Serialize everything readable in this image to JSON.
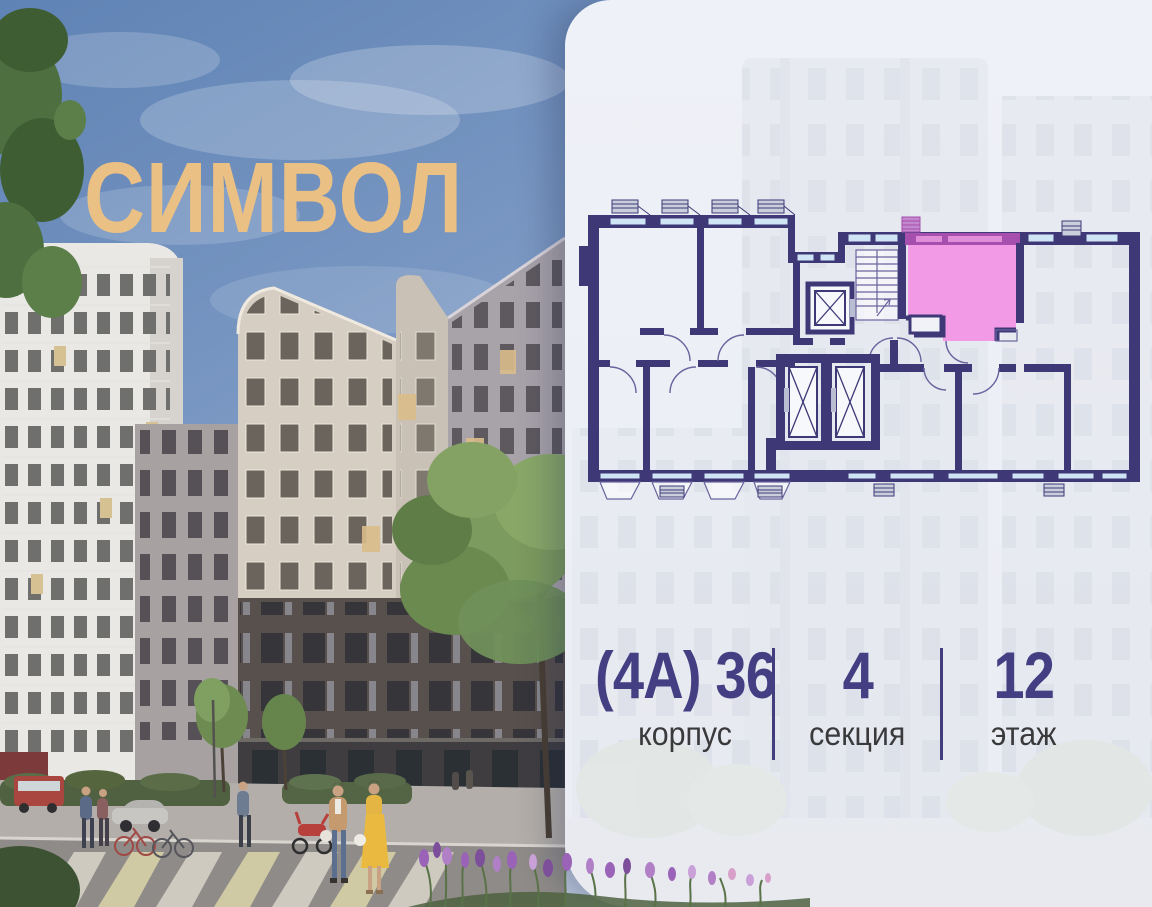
{
  "brand": {
    "logo_text": "СИМВОЛ",
    "logo_color": "#eac084"
  },
  "scene": {
    "description": "Street-level render of residential complex with pedestrians, trees and crosswalk"
  },
  "panel": {
    "floor_plan": {
      "wall_color": "#3e3877",
      "window_color": "#cfe4f5",
      "highlight_fill": "#f29ae6",
      "highlight_wall": "#a64fae",
      "selected_unit": "highlighted apartment on floor plan"
    },
    "stats": [
      {
        "value": "(4А) 36",
        "label": "корпус"
      },
      {
        "value": "4",
        "label": "секция"
      },
      {
        "value": "12",
        "label": "этаж"
      }
    ],
    "value_color": "#443e82",
    "label_color": "#3a3a3c",
    "divider_color": "#433d7e"
  }
}
